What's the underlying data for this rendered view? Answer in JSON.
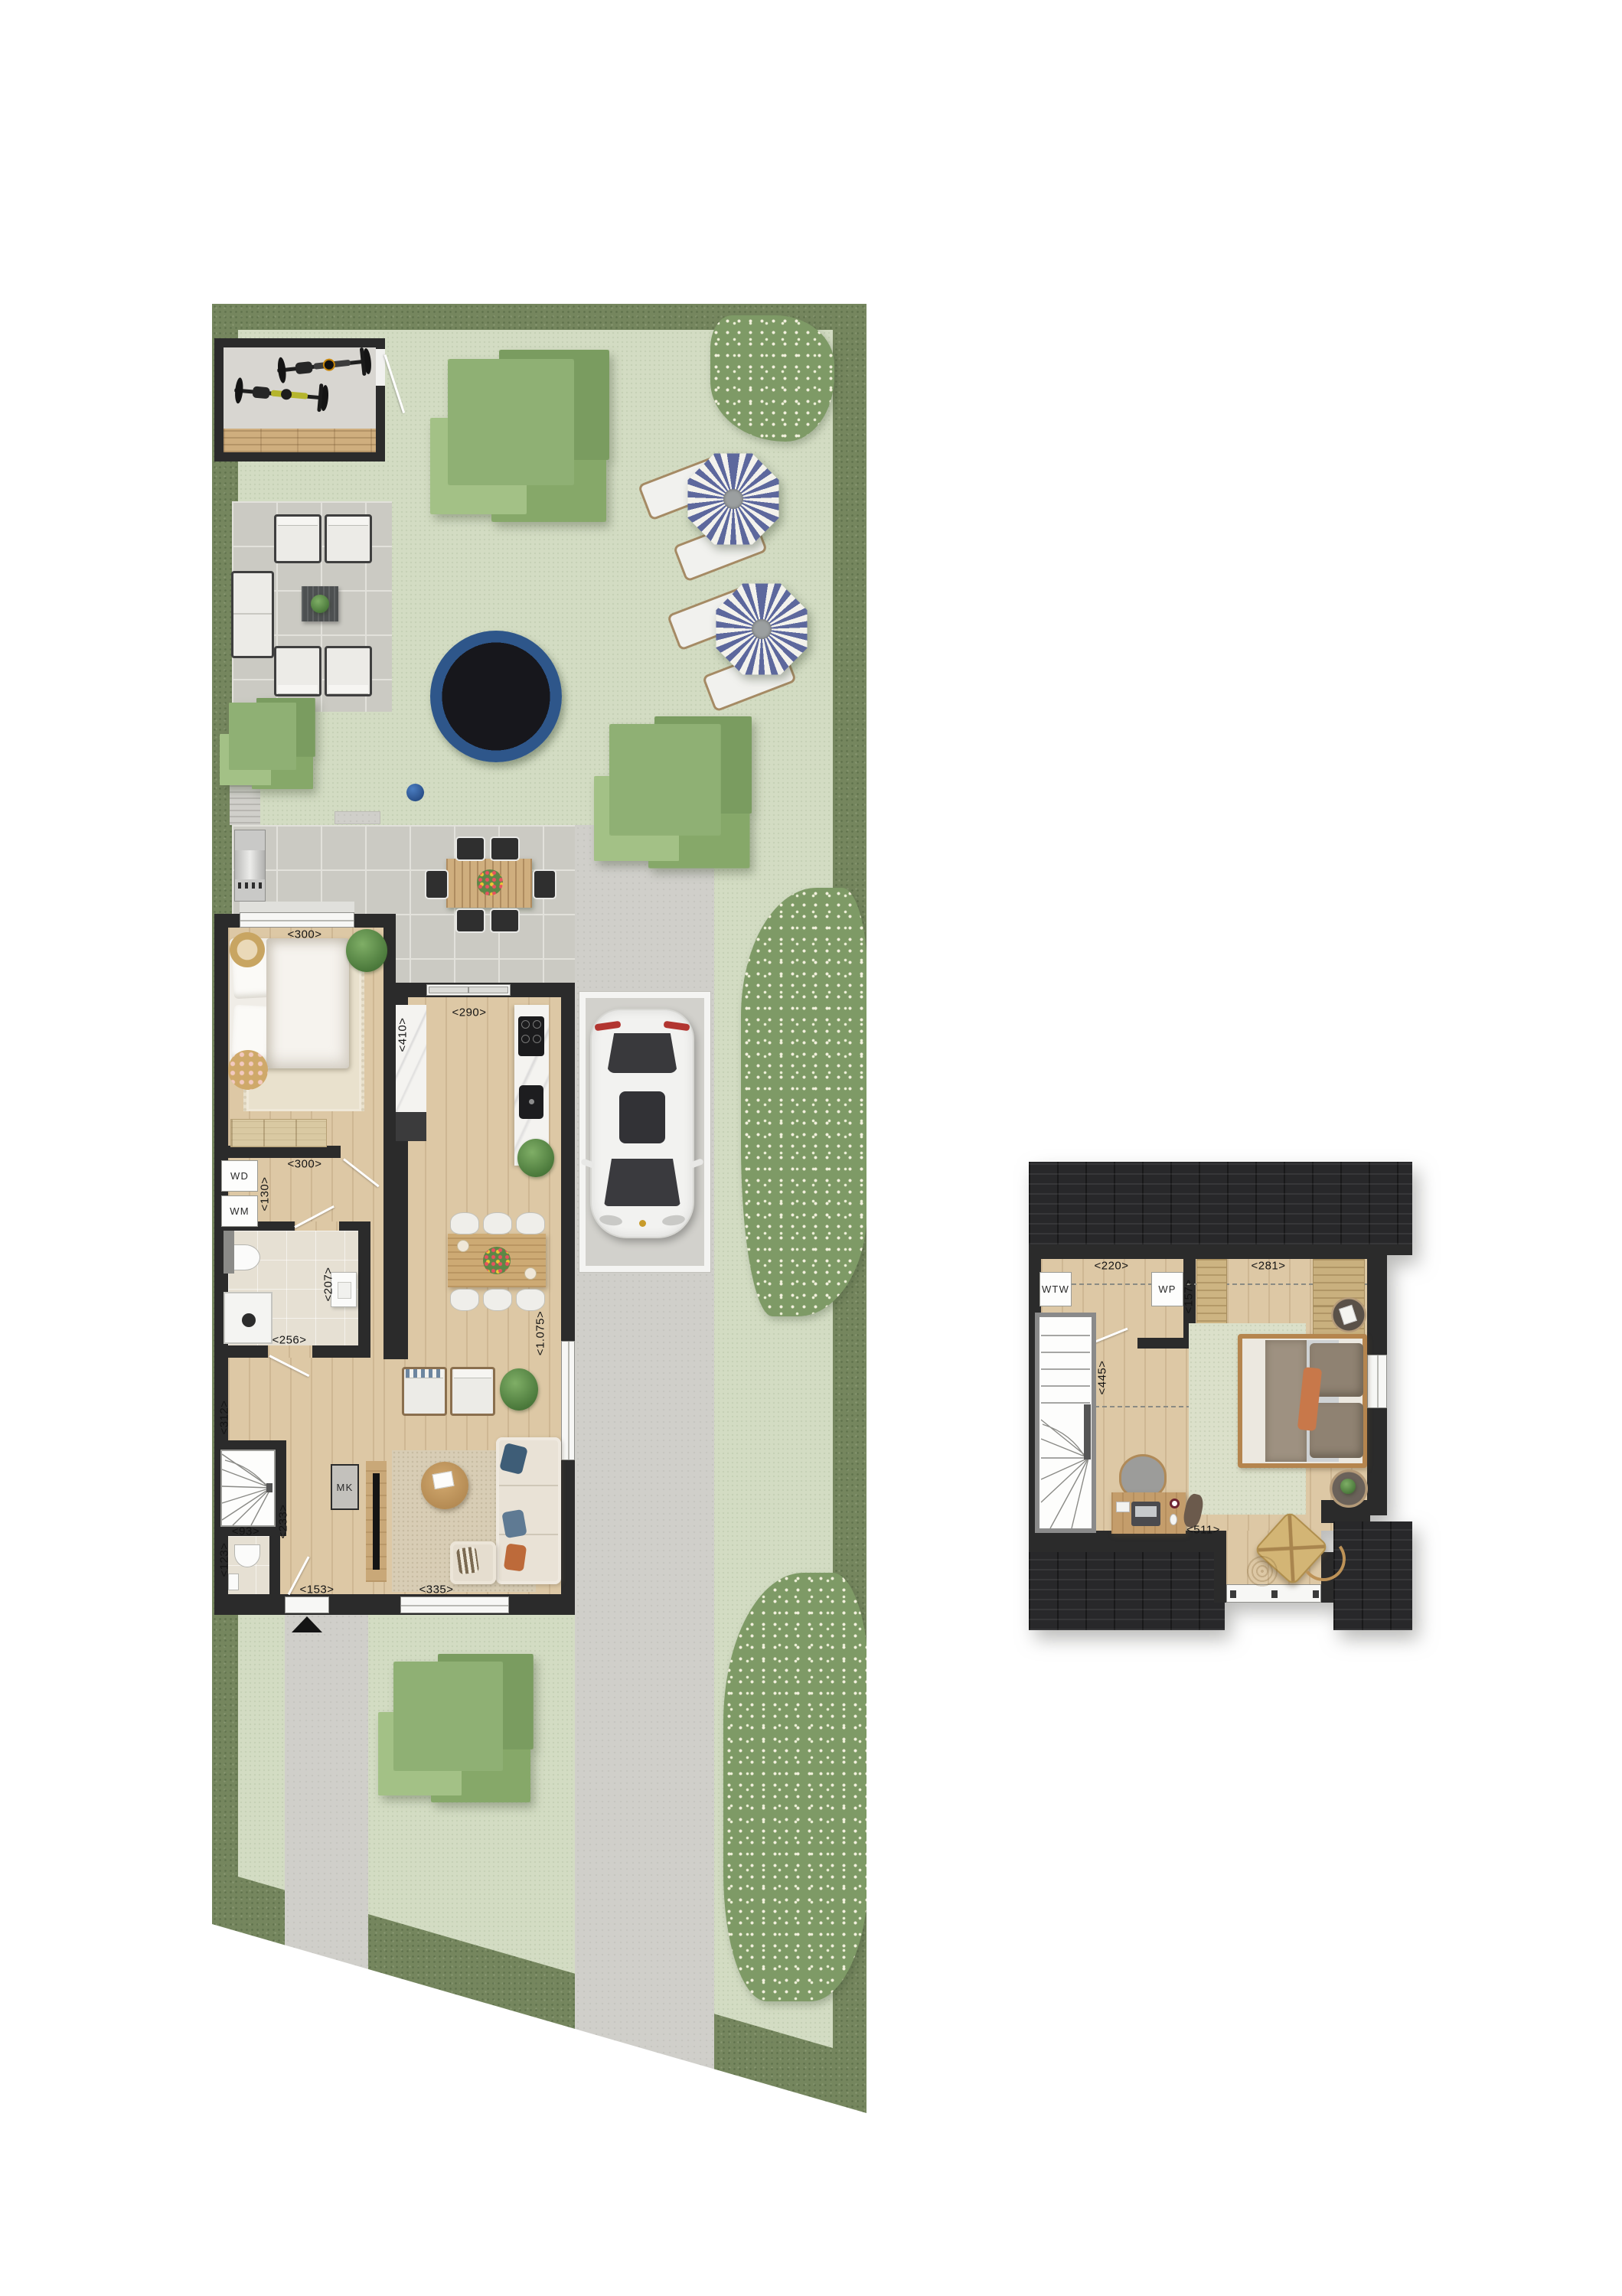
{
  "document": {
    "type": "residential floor plan with garden site plan",
    "views": [
      "ground-floor-with-garden",
      "first-floor"
    ]
  },
  "palette": {
    "hedge_green": "#75865e",
    "lawn_green": "#d3dcc3",
    "terrace_tile": "#cbcac3",
    "paving_grey": "#d0cfca",
    "wall_black": "#2b2b2b",
    "roof_dark": "#28282a",
    "wood_floor": "#ddc8a5",
    "bathroom_tile": "#e6e0d3",
    "trampoline_blue": "#2e568a",
    "parasol_blue": "#5d689d",
    "car_white": "#f2f2f0",
    "tree_green": "#86a869",
    "flower_bush_green": "#7e9a66"
  },
  "ground_floor": {
    "labels": {
      "bedroom_width": "<300>",
      "bedroom_depth": "<410>",
      "kitchen_width": "<290>",
      "laundry_hall_width": "<300>",
      "laundry_depth": "<130>",
      "dryer": "WD",
      "washer": "WM",
      "bathroom_depth": "<207>",
      "bathroom_width": "<256>",
      "stair_hall_depth": "<312>",
      "hall_width": "<233>",
      "toilet_width": "<93>",
      "toilet_depth": "<123>",
      "entrance_width": "<153>",
      "living_width": "<335>",
      "living_window_width": "<1.075>",
      "meter_cupboard": "MK"
    }
  },
  "upper_floor": {
    "labels": {
      "landing_width": "<220>",
      "tech_depth": "<157>",
      "bedroom_width": "<281>",
      "stair_depth": "<445>",
      "bedroom_length": "<511>",
      "heat_recovery_unit": "WTW",
      "heat_pump": "WP"
    }
  }
}
